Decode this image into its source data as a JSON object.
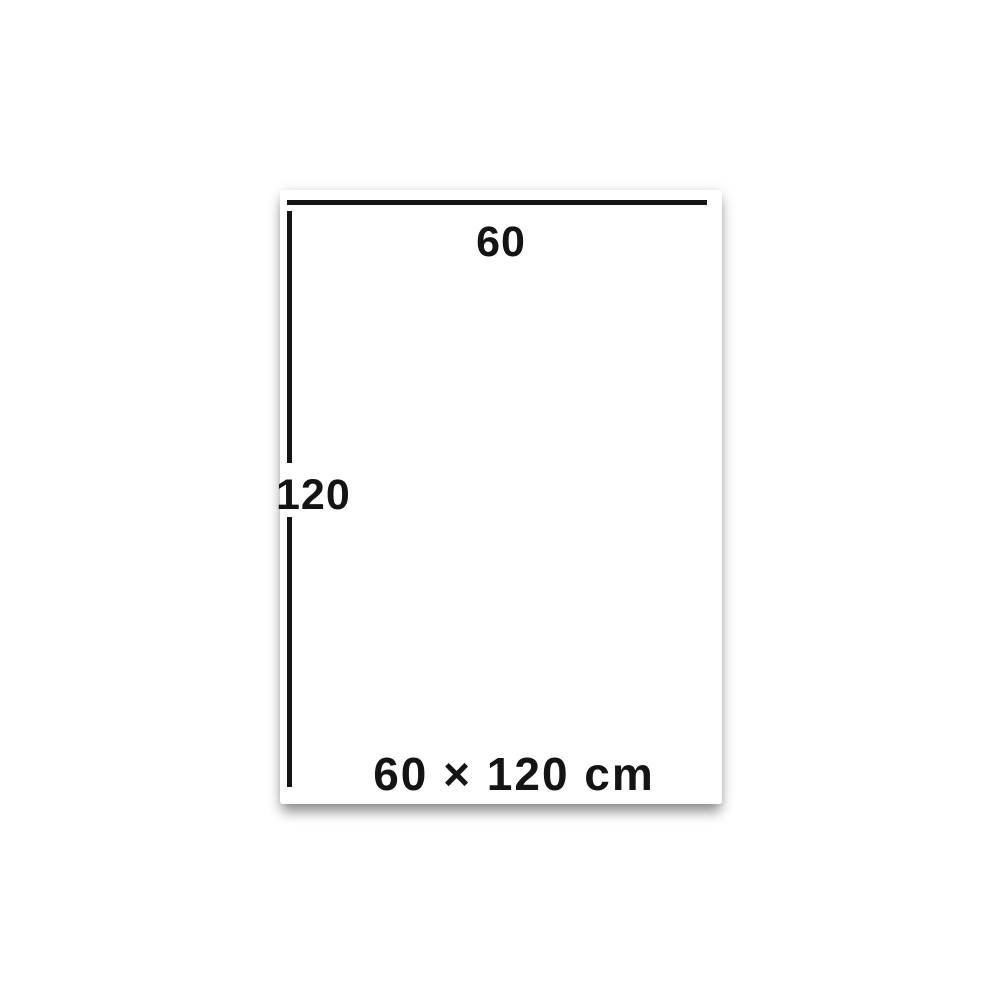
{
  "diagram": {
    "title": "product-dimension-diagram",
    "width_value": "60",
    "height_value": "120",
    "size_caption": "60 × 120 cm"
  },
  "colors": {
    "line": "#141414",
    "text": "#141414",
    "panel_background": "#ffffff",
    "page_background": "#ffffff"
  }
}
